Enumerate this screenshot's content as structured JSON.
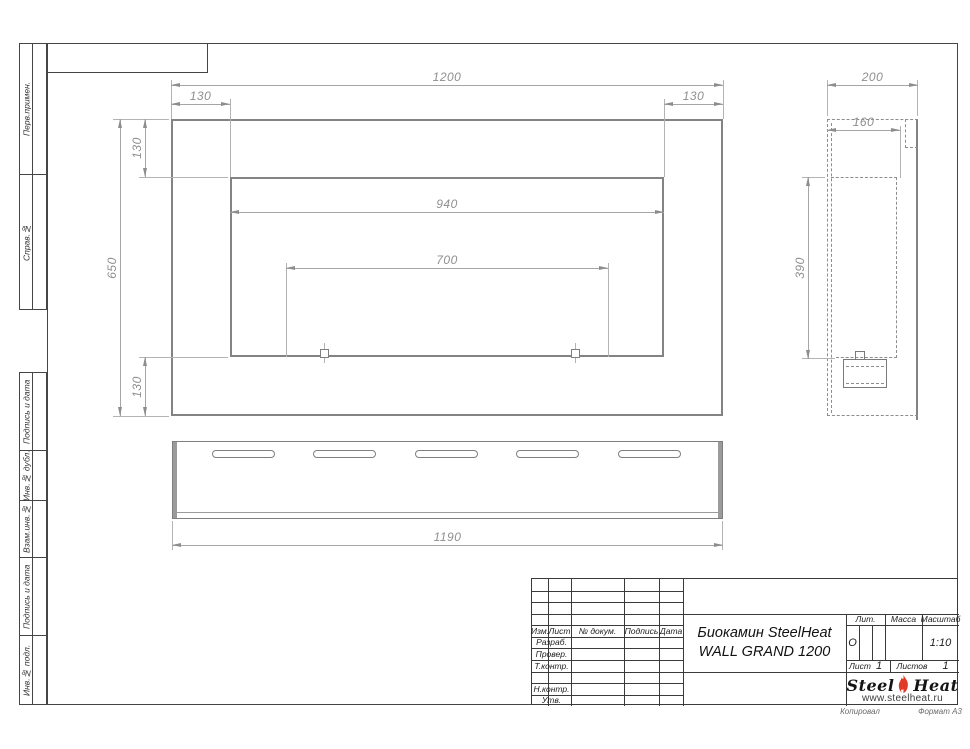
{
  "frame": {
    "labels_top": [
      "Перв.примен.",
      "Справ.№"
    ],
    "labels_bottom": [
      "Подпись и дата",
      "Инв.№ дубл.",
      "Взам.инв.№",
      "Подпись и дата",
      "Инв.№ подл."
    ],
    "footer_copy": "Копировал",
    "footer_format": "Формат А3"
  },
  "dims": {
    "front": {
      "width": "1200",
      "corner_l": "130",
      "corner_r": "130",
      "height": "650",
      "top": "130",
      "bottom": "130",
      "inner": "940",
      "burner": "700"
    },
    "side": {
      "depth": "200",
      "inner": "160",
      "height": "390"
    },
    "plan": {
      "length": "1190"
    }
  },
  "tb": {
    "h_izm": "Изм.",
    "h_list": "Лист",
    "h_doc": "№ докум.",
    "h_sign": "Подпись",
    "h_date": "Дата",
    "r1": "Разраб.",
    "r2": "Провер.",
    "r3": "Т.контр.",
    "r4": "Н.контр.",
    "r5": "Утв.",
    "title1": "Биокамин SteelHeat",
    "title2": "WALL GRAND 1200",
    "lit": "Лит.",
    "lit_v": "О",
    "mass": "Масса",
    "scale": "Масштаб",
    "scale_v": "1:10",
    "sheet": "Лист",
    "sheet_v": "1",
    "sheets": "Листов",
    "sheets_v": "1",
    "logo1": "Steel",
    "logo2": "Heat",
    "url": "www.steelheat.ru"
  },
  "colors": {
    "flame": "#e23a28"
  }
}
